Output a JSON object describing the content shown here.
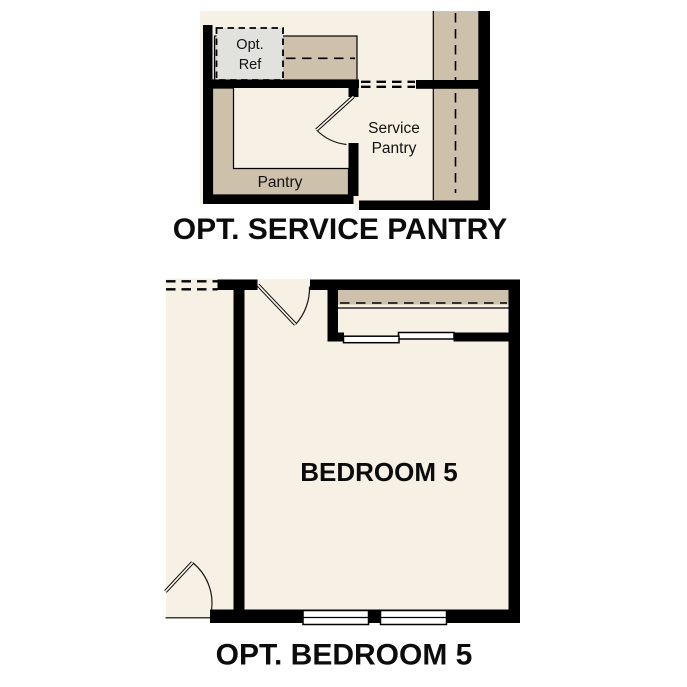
{
  "colors": {
    "background": "#ffffff",
    "floor": "#f7f0e4",
    "counter": "#cdc1ab",
    "optional_fridge_fill": "#e1e1de",
    "wall": "#000000",
    "window_fill": "#ffffff"
  },
  "service_pantry_plan": {
    "caption": "OPT. SERVICE PANTRY",
    "opt_ref_line1": "Opt.",
    "opt_ref_line2": "Ref",
    "pantry_label": "Pantry",
    "service_pantry_line1": "Service",
    "service_pantry_line2": "Pantry"
  },
  "bedroom_plan": {
    "caption": "OPT. BEDROOM 5",
    "room_label": "BEDROOM 5"
  }
}
